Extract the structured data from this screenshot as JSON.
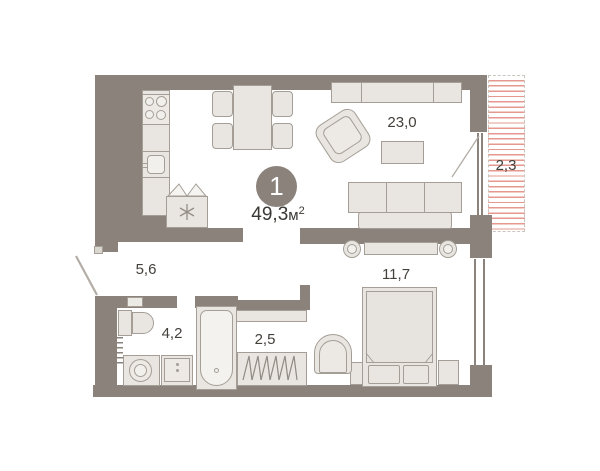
{
  "plan": {
    "unit_badge": "1",
    "total_area": {
      "value": "49,3",
      "unit": "м",
      "sup": "2"
    },
    "rooms": {
      "living": {
        "label": "23,0"
      },
      "balcony": {
        "label": "2,3"
      },
      "hallway": {
        "label": "5,6"
      },
      "bathroom": {
        "label": "4,2"
      },
      "wardrobe": {
        "label": "2,5"
      },
      "bedroom": {
        "label": "11,7"
      }
    },
    "colors": {
      "wall": "#8b837b",
      "furniture_fill": "#e9e6e1",
      "furniture_stroke": "#a49e96",
      "balcony_hatch": "#e5988f",
      "label_text": "#44403b"
    }
  }
}
